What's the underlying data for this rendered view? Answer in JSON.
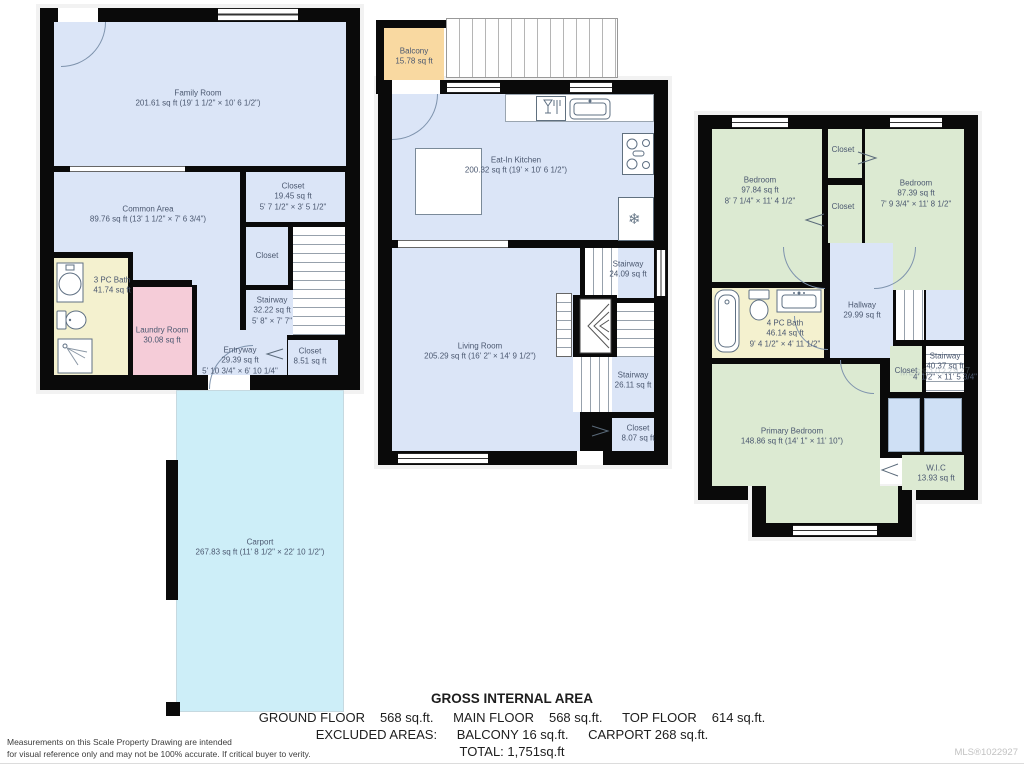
{
  "palette": {
    "room_blue": "#dbe5f7",
    "carport_cyan": "#cdeef8",
    "laundry_pink": "#f5ccd8",
    "bath_yellow": "#f4f1cf",
    "bedroom_green": "#dcead2",
    "balcony_orange": "#f9d9a1",
    "wall_black": "#0a0a0a",
    "label_color": "#4b5870"
  },
  "ground_floor": {
    "family_room": {
      "name": "Family Room",
      "area": "201.61 sq ft (19' 1 1/2\" × 10' 6 1/2\")"
    },
    "common_area": {
      "name": "Common Area",
      "area": "89.76 sq ft (13' 1 1/2\" × 7' 6 3/4\")"
    },
    "closet_large": {
      "name": "Closet",
      "area": "19.45 sq ft",
      "dims": "5' 7 1/2\" × 3' 5 1/2\""
    },
    "closet_small": {
      "name": "Closet"
    },
    "stairway": {
      "name": "Stairway",
      "area": "32.22 sq ft",
      "dims": "5' 8\" × 7' 7\""
    },
    "bath": {
      "name": "3 PC Bath",
      "area": "41.74 sq ft"
    },
    "laundry_room": {
      "name": "Laundry Room",
      "area": "30.08 sq ft"
    },
    "entryway": {
      "name": "Entryway",
      "area": "29.39 sq ft",
      "dims": "5' 10 3/4\" × 6' 10 1/4\""
    },
    "closet_entry": {
      "name": "Closet",
      "area": "8.51 sq ft"
    },
    "carport": {
      "name": "Carport",
      "area": "267.83 sq ft (11' 8 1/2\" × 22' 10 1/2\")"
    }
  },
  "main_floor": {
    "balcony": {
      "name": "Balcony",
      "area": "15.78 sq ft"
    },
    "eat_in_kitchen": {
      "name": "Eat-In Kitchen",
      "area": "200.32 sq ft (19' × 10' 6 1/2\")"
    },
    "living_room": {
      "name": "Living Room",
      "area": "205.29 sq ft (16' 2\" × 14' 9 1/2\")"
    },
    "stairway_upper": {
      "name": "Stairway",
      "area": "24.09 sq ft"
    },
    "stairway_lower": {
      "name": "Stairway",
      "area": "26.11 sq ft"
    },
    "closet": {
      "name": "Closet",
      "area": "8.07 sq ft"
    }
  },
  "top_floor": {
    "bedroom_left": {
      "name": "Bedroom",
      "area": "97.84 sq ft",
      "dims": "8' 7 1/4\" × 11' 4 1/2\""
    },
    "bedroom_right": {
      "name": "Bedroom",
      "area": "87.39 sq ft",
      "dims": "7' 9 3/4\" × 11' 8 1/2\""
    },
    "closet_top": {
      "name": "Closet"
    },
    "closet_mid": {
      "name": "Closet"
    },
    "hallway": {
      "name": "Hallway",
      "area": "29.99 sq ft"
    },
    "bath": {
      "name": "4 PC Bath",
      "area": "46.14 sq ft",
      "dims": "9' 4 1/2\" × 4' 11 1/2\""
    },
    "closet_stair": {
      "name": "Closet"
    },
    "stairway": {
      "name": "Stairway",
      "area": "40.37 sq ft",
      "dims": "4' 1/2\" × 11' 5 3/4\""
    },
    "primary_bedroom": {
      "name": "Primary Bedroom",
      "area": "148.86 sq ft (14' 1\" × 11' 10\")"
    },
    "wic": {
      "name": "W.I.C",
      "area": "13.93 sq ft"
    }
  },
  "icons": {
    "fridge_snowflake": "❄"
  },
  "summary": {
    "title": "GROSS INTERNAL AREA",
    "ground_label": "GROUND FLOOR",
    "ground_value": "568 sq.ft.",
    "main_label": "MAIN FLOOR",
    "main_value": "568 sq.ft.",
    "top_label": "TOP FLOOR",
    "top_value": "614 sq.ft.",
    "excluded_label": "EXCLUDED AREAS:",
    "excluded_balcony": "BALCONY 16 sq.ft.",
    "excluded_carport": "CARPORT 268 sq.ft.",
    "total": "TOTAL: 1,751sq.ft"
  },
  "footer": {
    "disclaimer_line1": "Measurements on this Scale Property Drawing are intended",
    "disclaimer_line2": "for visual reference only and may not be 100% accurate. If critical buyer to verity.",
    "mls": "MLS®1022927",
    "watermark": "MLS®1022927"
  }
}
